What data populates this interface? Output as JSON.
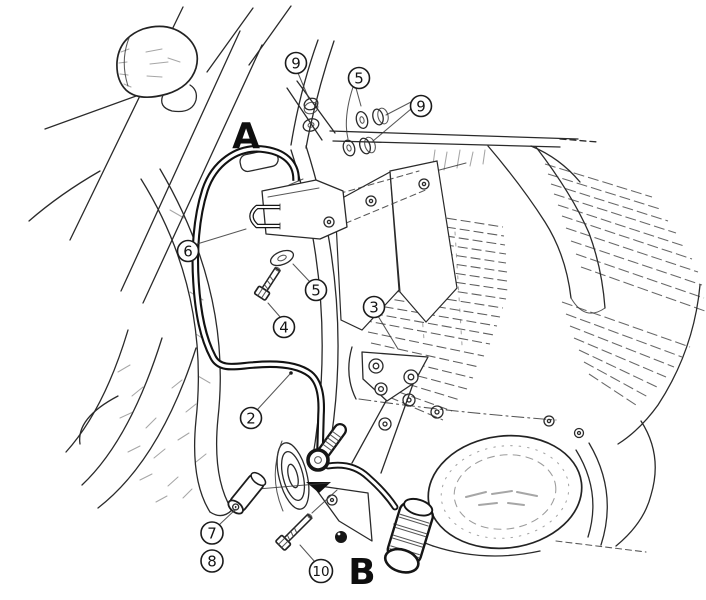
{
  "page": {
    "background": "#ffffff",
    "ink": "#1a1a1a"
  },
  "figure": {
    "kind": "exploded parts mounting diagram",
    "subject": "motorcycle engine guard / crash bar installation on V-twin cruiser, right-front view"
  },
  "section_labels": [
    {
      "label": "A"
    },
    {
      "label": "B"
    }
  ],
  "callouts": [
    {
      "label": "9"
    },
    {
      "label": "5"
    },
    {
      "label": "9"
    },
    {
      "label": "6"
    },
    {
      "label": "5"
    },
    {
      "label": "4"
    },
    {
      "label": "3"
    },
    {
      "label": "2"
    },
    {
      "label": "7"
    },
    {
      "label": "8"
    },
    {
      "label": "10"
    }
  ]
}
